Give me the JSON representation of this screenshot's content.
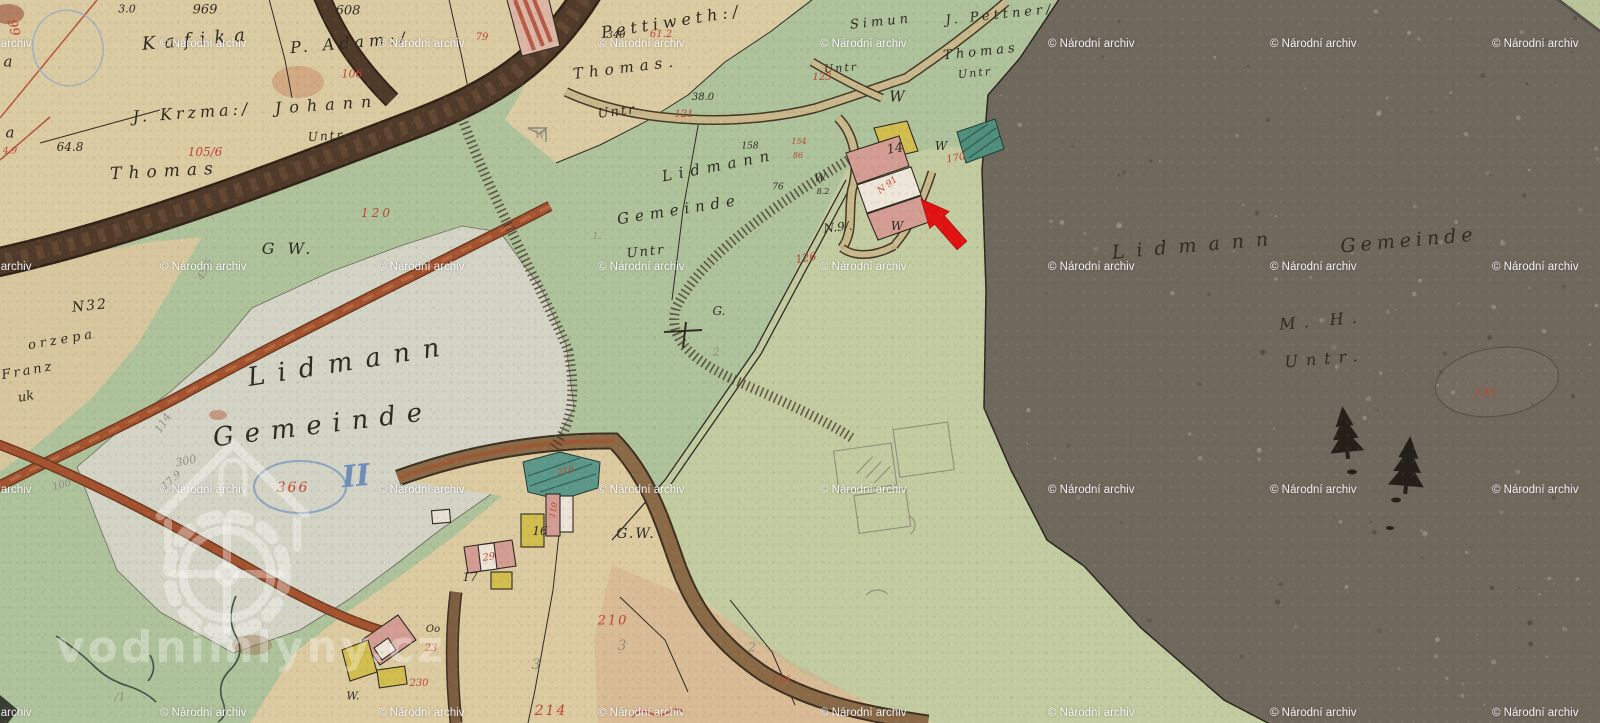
{
  "map": {
    "description": "historic cadastral map sheet",
    "watermark": {
      "text": "© Národní archiv",
      "cols": [
        -55,
        160,
        378,
        598,
        820,
        1048,
        1270,
        1492
      ],
      "rows": [
        38,
        261,
        484,
        707
      ]
    },
    "logo_watermark": {
      "text": "vodnimlyny.cz"
    },
    "annotation": {
      "type": "arrow",
      "color": "#e11212",
      "points": "921,199 949.2,211.4 944.4,215.7 966.9,241.2 957.1,249.8 934.6,224.3 929.7,228.6"
    },
    "colors": {
      "paper": "#dbcba2",
      "green": "#aec29b",
      "light_green": "#c3cba1",
      "white_field": "#d3d4c6",
      "forest": "#6f685c",
      "road_dark": "#503a29",
      "road_red": "#a5532f",
      "building_pink": "#d49d94",
      "building_yellow": "#d2bd4f",
      "pond_teal": "#4f8f7c",
      "ink": "#2e2a22",
      "red_ink": "#bf4434",
      "pencil": "#8b887a",
      "blue_ink": "#6f8fb8",
      "arrow": "#e11212",
      "watermark": "#ffffff"
    },
    "labels": {
      "ink": [
        {
          "t": "969",
          "x": 205,
          "y": 10,
          "s": 13
        },
        {
          "t": "3.0",
          "x": 127,
          "y": 9,
          "s": 11
        },
        {
          "t": "608",
          "x": 348,
          "y": 11,
          "s": 13
        },
        {
          "t": "Kafika",
          "x": 198,
          "y": 40,
          "s": 18,
          "r": -5,
          "ls": 9
        },
        {
          "t": "P. Adam:/",
          "x": 350,
          "y": 43,
          "s": 16,
          "r": -5,
          "ls": 5
        },
        {
          "t": "J. Krzma:/",
          "x": 192,
          "y": 113,
          "s": 16,
          "r": -4,
          "ls": 4
        },
        {
          "t": "Johann",
          "x": 327,
          "y": 105,
          "s": 16,
          "r": -4,
          "ls": 8
        },
        {
          "t": "Untr",
          "x": 326,
          "y": 136,
          "s": 12,
          "r": -4,
          "ls": 2
        },
        {
          "t": "Thomas",
          "x": 165,
          "y": 172,
          "s": 17,
          "r": -3,
          "ls": 7
        },
        {
          "t": "64.8",
          "x": 70,
          "y": 147,
          "s": 12
        },
        {
          "t": "Pettiweth:/",
          "x": 672,
          "y": 22,
          "s": 16,
          "r": -9,
          "ls": 5
        },
        {
          "t": "340",
          "x": 616,
          "y": 36,
          "s": 10
        },
        {
          "t": "Thomas.",
          "x": 626,
          "y": 68,
          "s": 15,
          "r": -7,
          "ls": 6
        },
        {
          "t": "Untr",
          "x": 617,
          "y": 112,
          "s": 13,
          "r": -7,
          "ls": 2
        },
        {
          "t": "38.0",
          "x": 703,
          "y": 98,
          "s": 10
        },
        {
          "t": "158",
          "x": 750,
          "y": 147,
          "s": 9
        },
        {
          "t": "Lidmann",
          "x": 719,
          "y": 166,
          "s": 15,
          "r": -11,
          "ls": 7
        },
        {
          "t": "Gemeinde",
          "x": 679,
          "y": 210,
          "s": 15,
          "r": -9,
          "ls": 6
        },
        {
          "t": "Untr",
          "x": 646,
          "y": 252,
          "s": 13,
          "r": -6,
          "ls": 2
        },
        {
          "t": "76",
          "x": 778,
          "y": 188,
          "s": 9
        },
        {
          "t": "G.",
          "x": 719,
          "y": 311,
          "s": 12
        },
        {
          "t": "Simun",
          "x": 881,
          "y": 22,
          "s": 13,
          "r": -6,
          "ls": 4
        },
        {
          "t": "J. Pettner/",
          "x": 1000,
          "y": 15,
          "s": 13,
          "r": -6,
          "ls": 4
        },
        {
          "t": "Thomas",
          "x": 981,
          "y": 52,
          "s": 13,
          "r": -6,
          "ls": 4
        },
        {
          "t": "Untr",
          "x": 975,
          "y": 73,
          "s": 11,
          "r": -6,
          "ls": 2
        },
        {
          "t": "Untr",
          "x": 841,
          "y": 68,
          "s": 11,
          "r": -4,
          "ls": 2
        },
        {
          "t": "W",
          "x": 897,
          "y": 97,
          "s": 15
        },
        {
          "t": "W",
          "x": 941,
          "y": 146,
          "s": 12
        },
        {
          "t": "W",
          "x": 897,
          "y": 226,
          "s": 12
        },
        {
          "t": "W",
          "x": 820,
          "y": 178,
          "s": 11
        },
        {
          "t": "8.2",
          "x": 823,
          "y": 192,
          "s": 8
        },
        {
          "t": "N.9/.",
          "x": 838,
          "y": 227,
          "s": 12,
          "r": -6
        },
        {
          "t": "14",
          "x": 895,
          "y": 149,
          "s": 13,
          "r": -10
        },
        {
          "t": "G W.",
          "x": 288,
          "y": 249,
          "s": 16,
          "ls": 4
        },
        {
          "t": "N32",
          "x": 90,
          "y": 306,
          "s": 14,
          "r": -6,
          "ls": 2
        },
        {
          "t": "orzepa",
          "x": 62,
          "y": 340,
          "s": 13,
          "r": -10,
          "ls": 4
        },
        {
          "t": "Franz",
          "x": 28,
          "y": 371,
          "s": 13,
          "r": -10,
          "ls": 3
        },
        {
          "t": "Lidmann",
          "x": 350,
          "y": 362,
          "s": 26,
          "r": -9,
          "ls": 13
        },
        {
          "t": "Gemeinde",
          "x": 323,
          "y": 425,
          "s": 26,
          "r": -7,
          "ls": 11
        },
        {
          "t": "Lidmann",
          "x": 1196,
          "y": 246,
          "s": 19,
          "r": -5,
          "ls": 12
        },
        {
          "t": "Gemeinde",
          "x": 1409,
          "y": 241,
          "s": 19,
          "r": -5,
          "ls": 5
        },
        {
          "t": "M. H.",
          "x": 1322,
          "y": 321,
          "s": 16,
          "r": -5,
          "ls": 8
        },
        {
          "t": "Untr.",
          "x": 1325,
          "y": 359,
          "s": 16,
          "r": -5,
          "ls": 8
        },
        {
          "t": "G.W.",
          "x": 636,
          "y": 534,
          "s": 14,
          "ls": 2
        },
        {
          "t": "16",
          "x": 540,
          "y": 531,
          "s": 12
        },
        {
          "t": "17",
          "x": 470,
          "y": 577,
          "s": 12
        },
        {
          "t": "W.",
          "x": 353,
          "y": 696,
          "s": 11
        },
        {
          "t": "Oo",
          "x": 433,
          "y": 630,
          "s": 10
        },
        {
          "t": "a",
          "x": 8,
          "y": 62,
          "s": 15
        },
        {
          "t": "a",
          "x": 10,
          "y": 133,
          "s": 15
        },
        {
          "t": "uk",
          "x": 26,
          "y": 397,
          "s": 13,
          "r": -10
        }
      ],
      "red": [
        {
          "t": "99",
          "x": 13,
          "y": 28,
          "s": 13,
          "r": 75
        },
        {
          "t": "106",
          "x": 352,
          "y": 74,
          "s": 11
        },
        {
          "t": "105/6",
          "x": 205,
          "y": 152,
          "s": 12
        },
        {
          "t": "79",
          "x": 482,
          "y": 38,
          "s": 10
        },
        {
          "t": "61.2",
          "x": 661,
          "y": 35,
          "s": 10
        },
        {
          "t": "121",
          "x": 684,
          "y": 115,
          "s": 10
        },
        {
          "t": "123",
          "x": 822,
          "y": 78,
          "s": 10
        },
        {
          "t": "120",
          "x": 377,
          "y": 213,
          "s": 12,
          "ls": 3
        },
        {
          "t": "126",
          "x": 806,
          "y": 258,
          "s": 11,
          "r": -10
        },
        {
          "t": "154",
          "x": 799,
          "y": 142,
          "s": 8
        },
        {
          "t": "86",
          "x": 798,
          "y": 156,
          "s": 8
        },
        {
          "t": "170",
          "x": 956,
          "y": 159,
          "s": 10,
          "r": -10
        },
        {
          "t": "N 91",
          "x": 888,
          "y": 186,
          "s": 9,
          "r": -37
        },
        {
          "t": "135",
          "x": 1485,
          "y": 393,
          "s": 11
        },
        {
          "t": "366",
          "x": 293,
          "y": 488,
          "s": 14,
          "ls": 2
        },
        {
          "t": "210",
          "x": 613,
          "y": 621,
          "s": 13,
          "ls": 2
        },
        {
          "t": "214",
          "x": 551,
          "y": 711,
          "s": 14,
          "ls": 2
        },
        {
          "t": "230",
          "x": 419,
          "y": 684,
          "s": 10
        },
        {
          "t": "23",
          "x": 431,
          "y": 649,
          "s": 10
        },
        {
          "t": "29",
          "x": 489,
          "y": 558,
          "s": 10,
          "r": -8
        },
        {
          "t": "116",
          "x": 781,
          "y": 681,
          "s": 10
        },
        {
          "t": "110",
          "x": 554,
          "y": 510,
          "s": 8,
          "r": -80
        },
        {
          "t": "4.9",
          "x": 10,
          "y": 152,
          "s": 9
        },
        {
          "t": "218",
          "x": 566,
          "y": 472,
          "s": 9,
          "r": -15
        }
      ],
      "pencil": [
        {
          "t": "300",
          "x": 186,
          "y": 461,
          "s": 11,
          "r": -12
        },
        {
          "t": "17.9",
          "x": 172,
          "y": 481,
          "s": 10,
          "r": -42
        },
        {
          "t": "100",
          "x": 62,
          "y": 486,
          "s": 10,
          "r": -16
        },
        {
          "t": "114",
          "x": 163,
          "y": 423,
          "s": 11,
          "r": -58
        },
        {
          "t": "45/5",
          "x": 206,
          "y": 270,
          "s": 10,
          "r": -62
        },
        {
          "t": "3",
          "x": 536,
          "y": 665,
          "s": 14
        },
        {
          "t": "3",
          "x": 622,
          "y": 646,
          "s": 14
        },
        {
          "t": "2",
          "x": 752,
          "y": 648,
          "s": 13
        },
        {
          "t": "W",
          "x": 540,
          "y": 136,
          "s": 10
        },
        {
          "t": "2",
          "x": 716,
          "y": 352,
          "s": 11
        },
        {
          "t": "/1",
          "x": 120,
          "y": 697,
          "s": 11
        },
        {
          "t": "1.",
          "x": 597,
          "y": 237,
          "s": 10
        }
      ],
      "blue": [
        {
          "t": "II",
          "x": 356,
          "y": 477,
          "s": 30,
          "r": -5
        }
      ]
    }
  }
}
